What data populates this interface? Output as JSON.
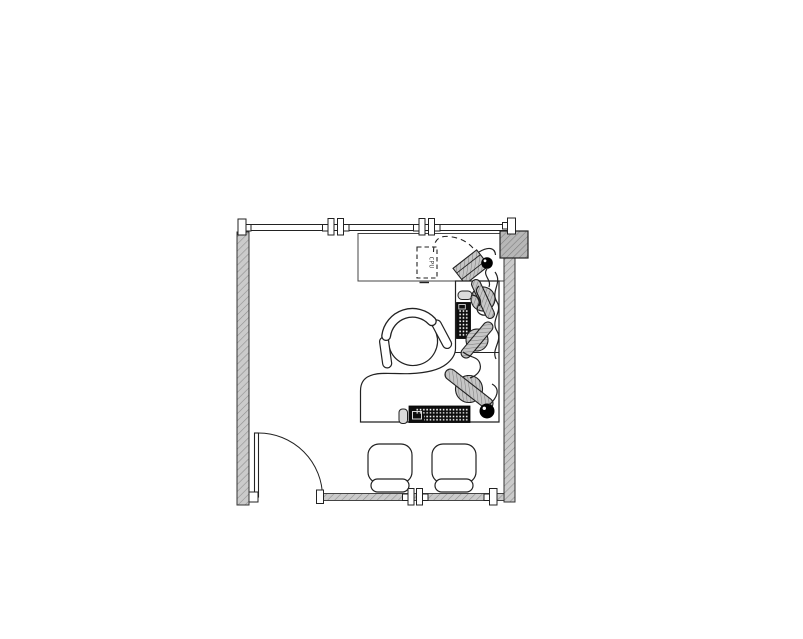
{
  "drawing": {
    "cpu_label": "CPU",
    "colors": {
      "background": "#ffffff",
      "wall_fill": "#cbcbcb",
      "wall_hatch": "#8f8f8f",
      "column_fill": "#b7b7b7",
      "line": "#222222",
      "device_black": "#0d0d0d",
      "phone_gray": "#c6c6c6",
      "mouse_gray": "#dcdcdc"
    },
    "symbols": [
      "window-mullion-wall-top",
      "window-sill-wall-bottom",
      "left-wall",
      "right-wall",
      "building-column",
      "door-with-swing",
      "credenza",
      "corner-desk",
      "task-chair",
      "guest-chair",
      "cpu-tower-dashed",
      "telephone",
      "keyboard",
      "mouse",
      "cable-squiggles"
    ]
  }
}
